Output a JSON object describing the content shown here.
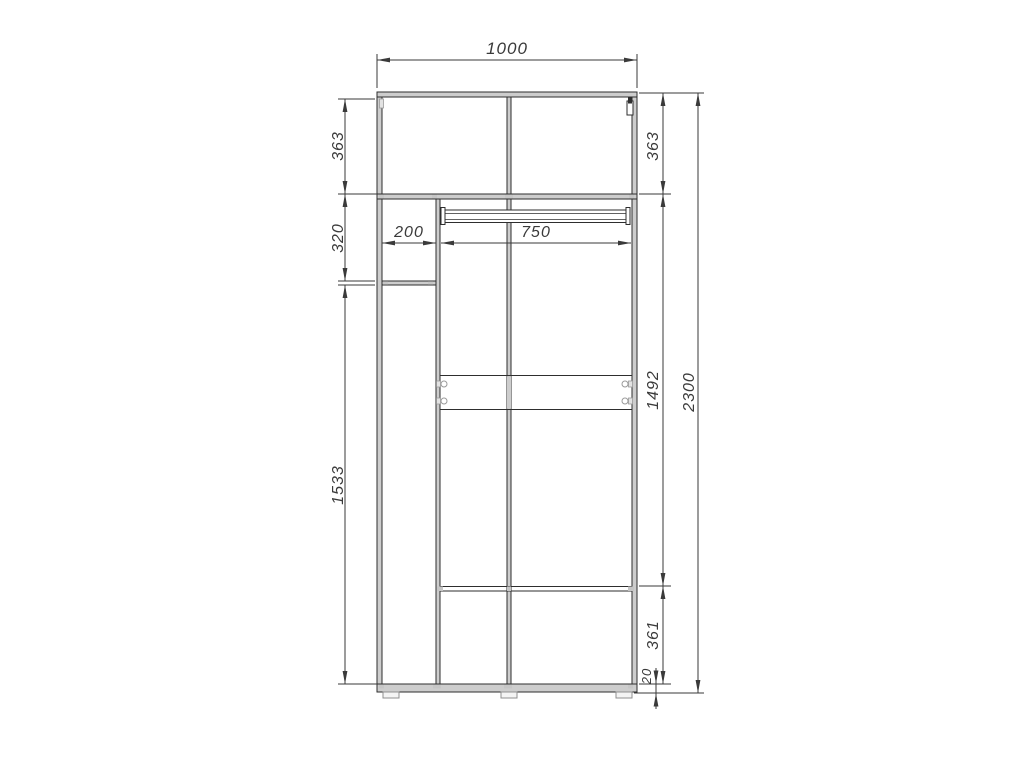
{
  "colors": {
    "background": "#ffffff",
    "structure_line": "#2e2e2e",
    "panel_fill": "#cdcdcd",
    "dimension_line": "#3a3a3a",
    "label_text": "#3a3a3a"
  },
  "dim_labels": {
    "overall_width": "1000",
    "top_left_height": "363",
    "top_right_height": "363",
    "left_shelf_gap": "320",
    "left_column_width": "200",
    "main_section_width": "750",
    "left_lower_height": "1533",
    "main_inner_height": "1492",
    "overall_height": "2300",
    "bottom_section_height": "361",
    "base_thickness": "20"
  }
}
